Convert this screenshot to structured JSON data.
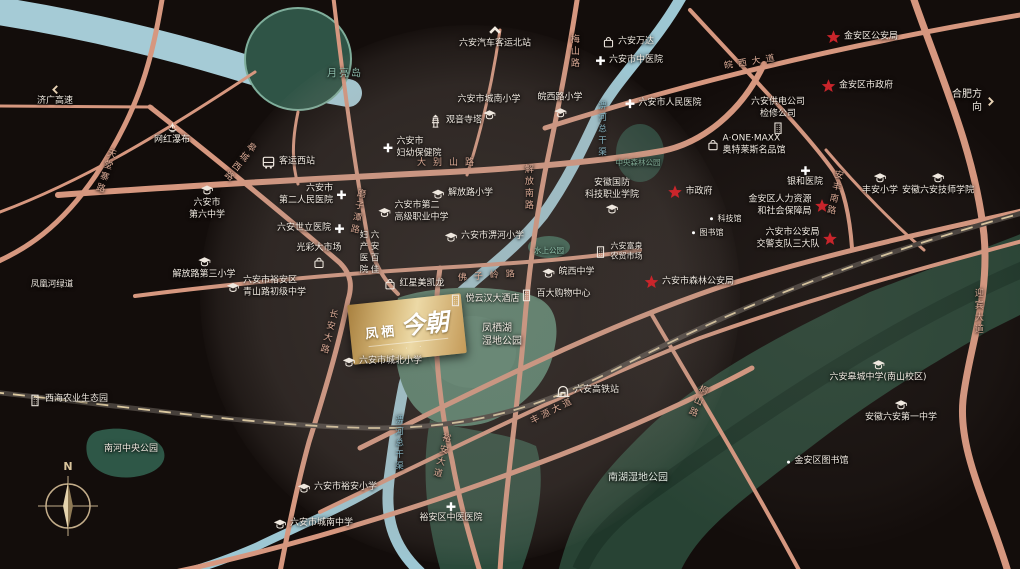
{
  "logo": {
    "brand": "凤栖",
    "script": "今朝",
    "caption": "· · ·"
  },
  "compass": {
    "north": "N"
  },
  "colors": {
    "road": "#d6977f",
    "water": "#9dc7d3",
    "wetland": "#284334",
    "lake_park": "#527d68",
    "star_red": "#c9252b",
    "label": "#f1eae1",
    "road_label": "#dcab96",
    "logo_gold": "#d8ba7c"
  },
  "pois": [
    {
      "name": "jiguang-expressway-sign",
      "label": "济广高速",
      "icon": "chev-left",
      "x": 55,
      "y": 96,
      "lay": "col",
      "ic": "#e8d2b4"
    },
    {
      "name": "north-bus-station-sign",
      "label": "六安汽车客运北站",
      "icon": "chev-up",
      "x": 495,
      "y": 37,
      "lay": "col",
      "ic": "#f0e9df"
    },
    {
      "name": "hefei-direction-sign",
      "label": "合肥方向",
      "icon": "chev-right",
      "x": 972,
      "y": 101,
      "lay": "row-r",
      "ic": "#e8d2b4",
      "fs": 10
    },
    {
      "name": "wanghong-waterfall",
      "label": "网红瀑布",
      "icon": "fountain",
      "x": 172,
      "y": 134,
      "lay": "col"
    },
    {
      "name": "west-bus-station",
      "label": "客运西站",
      "icon": "bus",
      "x": 288,
      "y": 162,
      "lay": "row"
    },
    {
      "name": "moon-island",
      "label": "月亮岛",
      "x": 345,
      "y": 74,
      "lay": "text",
      "c": "#8fbfae",
      "fs": 10,
      "ls": 2
    },
    {
      "name": "meishan-road",
      "label": "梅山路",
      "x": 573,
      "y": 52,
      "lay": "text",
      "vert": true,
      "c": "#dcab96"
    },
    {
      "name": "wanda-mall",
      "label": "六安万达",
      "icon": "bag",
      "x": 628,
      "y": 42,
      "lay": "row"
    },
    {
      "name": "tcm-hospital",
      "label": "六安市中医院",
      "icon": "cross",
      "x": 629,
      "y": 61,
      "lay": "row"
    },
    {
      "name": "chengnan-primary",
      "label": "六安市城南小学",
      "icon": "cap",
      "x": 489,
      "y": 108,
      "lay": "col-r"
    },
    {
      "name": "wanxilu-primary",
      "label": "皖西路小学",
      "icon": "cap",
      "x": 560,
      "y": 106,
      "lay": "col-r"
    },
    {
      "name": "renmin-hospital",
      "label": "六安市人民医院",
      "icon": "cross",
      "x": 663,
      "y": 104,
      "lay": "row"
    },
    {
      "name": "guanyin-pagoda",
      "label": "观音寺塔",
      "icon": "pagoda",
      "x": 455,
      "y": 121,
      "lay": "row"
    },
    {
      "name": "maternity-care-hospital",
      "label": "六安市\n妇幼保健院",
      "icon": "cross",
      "x": 412,
      "y": 148,
      "lay": "row"
    },
    {
      "name": "dabieshan-road",
      "label": "大别山路",
      "x": 449,
      "y": 164,
      "lay": "text",
      "c": "#dcab96",
      "ls": 7
    },
    {
      "name": "tiantangzhai-road",
      "label": "天堂寨路",
      "x": 104,
      "y": 171,
      "lay": "text",
      "vert": true,
      "c": "#dcab96",
      "rot": 18
    },
    {
      "name": "gaochengxi-road",
      "label": "皋城西路",
      "x": 238,
      "y": 161,
      "lay": "text",
      "vert": true,
      "c": "#dcab96",
      "rot": 38
    },
    {
      "name": "no6-middle-school",
      "label": "六安市\n第六中学",
      "icon": "cap",
      "x": 207,
      "y": 202,
      "lay": "col"
    },
    {
      "name": "no2-renmin-hospital",
      "label": "六安市\n第二人民医院",
      "icon": "cross",
      "x": 313,
      "y": 195,
      "lay": "row-r"
    },
    {
      "name": "shili-hospital",
      "label": "六安世立医院",
      "icon": "cross",
      "x": 311,
      "y": 229,
      "lay": "row-r"
    },
    {
      "name": "guangcai-market",
      "label": "光彩大市场",
      "icon": "bag",
      "x": 319,
      "y": 256,
      "lay": "col-r"
    },
    {
      "name": "qingshanlu-junior-middle-school",
      "label": "六安市裕安区\n青山路初级中学",
      "icon": "cap",
      "x": 266,
      "y": 287,
      "lay": "row"
    },
    {
      "name": "jiefanglu-no3-primary",
      "label": "解放路第三小学",
      "icon": "cap",
      "x": 204,
      "y": 268,
      "lay": "col"
    },
    {
      "name": "fenghuang-river-greenway",
      "label": "凤凰河绿道",
      "x": 52,
      "y": 285,
      "lay": "text",
      "fs": 8.5
    },
    {
      "name": "mozitan-road",
      "label": "磨子潭路",
      "x": 356,
      "y": 212,
      "lay": "text",
      "vert": true,
      "c": "#dcab96",
      "rot": 10
    },
    {
      "name": "no2-vocational-school",
      "label": "六安市第二\n高级职业中学",
      "icon": "cap",
      "x": 413,
      "y": 212,
      "lay": "row"
    },
    {
      "name": "jiefanglu-primary",
      "label": "解放路小学",
      "icon": "cap",
      "x": 462,
      "y": 194,
      "lay": "row"
    },
    {
      "name": "pihe-primary",
      "label": "六安市淠河小学",
      "icon": "cap",
      "x": 484,
      "y": 237,
      "lay": "row"
    },
    {
      "name": "jiefangnan-road",
      "label": "解放南路",
      "x": 527,
      "y": 188,
      "lay": "text",
      "vert": true,
      "c": "#dcab96"
    },
    {
      "name": "baijia-maternity-hospital",
      "label": "六安百佳\n妇产医院",
      "x": 368,
      "y": 253,
      "lay": "text",
      "vert": true,
      "fs": 8.5
    },
    {
      "name": "hongxing-meikailong",
      "label": "红星美凯龙",
      "icon": "bag",
      "x": 414,
      "y": 284,
      "lay": "row"
    },
    {
      "name": "foziling-road",
      "label": "佛子岭路",
      "x": 490,
      "y": 277,
      "lay": "text",
      "c": "#dcab96",
      "ls": 7,
      "rot": -4
    },
    {
      "name": "guofang-tech-college",
      "label": "安徽国防\n科技职业学院",
      "icon": "cap",
      "x": 612,
      "y": 197,
      "lay": "col-r"
    },
    {
      "name": "central-forest-park",
      "label": "中央森林公园",
      "x": 638,
      "y": 163,
      "lay": "text",
      "c": "#7fa893",
      "fs": 7.5
    },
    {
      "name": "pihe-main-channel-north",
      "label": "淠河总干渠",
      "x": 601,
      "y": 130,
      "lay": "text",
      "vert": true,
      "c": "#86b4c2",
      "fs": 8.5
    },
    {
      "name": "city-hall",
      "label": "市政府",
      "icon": "star",
      "x": 690,
      "y": 192,
      "lay": "row"
    },
    {
      "name": "science-museum",
      "label": "科技馆",
      "icon": "dot",
      "x": 725,
      "y": 219,
      "lay": "row",
      "fs": 8
    },
    {
      "name": "library",
      "label": "图书馆",
      "icon": "dot",
      "x": 707,
      "y": 233,
      "lay": "row",
      "fs": 8
    },
    {
      "name": "power-supply-company",
      "label": "六安供电公司\n检修公司",
      "icon": "building",
      "x": 778,
      "y": 116,
      "lay": "col-r"
    },
    {
      "name": "aone-maxx-outlets",
      "label": "A·ONE·MAXX\n奥特莱斯名品馆",
      "icon": "bag",
      "x": 746,
      "y": 145,
      "lay": "row"
    },
    {
      "name": "jinan-district-police",
      "label": "金安区公安局",
      "icon": "star",
      "x": 862,
      "y": 37,
      "lay": "row"
    },
    {
      "name": "wanxi-avenue",
      "label": "皖西大道",
      "x": 752,
      "y": 63,
      "lay": "text",
      "c": "#dcab96",
      "ls": 5,
      "rot": -9
    },
    {
      "name": "jinan-district-govt",
      "label": "金安区市政府",
      "icon": "star",
      "x": 857,
      "y": 86,
      "lay": "row"
    },
    {
      "name": "yinhe-hospital",
      "label": "银和医院",
      "icon": "cross",
      "x": 805,
      "y": 177,
      "lay": "col"
    },
    {
      "name": "fengan-primary",
      "label": "丰安小学",
      "icon": "cap",
      "x": 880,
      "y": 184,
      "lay": "col"
    },
    {
      "name": "luan-technician-college",
      "label": "安徽六安技师学院",
      "icon": "cap",
      "x": 938,
      "y": 184,
      "lay": "col"
    },
    {
      "name": "hr-social-security-bureau",
      "label": "金安区人力资源\n和社会保障局",
      "icon": "star",
      "x": 789,
      "y": 206,
      "lay": "row-r"
    },
    {
      "name": "traffic-police-no3",
      "label": "六安市公安局\n交警支队三大队",
      "icon": "star",
      "x": 797,
      "y": 239,
      "lay": "row-r"
    },
    {
      "name": "forest-police-bureau",
      "label": "六安市森林公安局",
      "icon": "star",
      "x": 689,
      "y": 282,
      "lay": "row"
    },
    {
      "name": "anfengnan-road",
      "label": "安丰南路",
      "x": 833,
      "y": 193,
      "lay": "text",
      "vert": true,
      "c": "#dcab96",
      "rot": 12
    },
    {
      "name": "water-park",
      "label": "水上公园",
      "x": 549,
      "y": 251,
      "lay": "text",
      "c": "#8fc0aa",
      "fs": 7.5
    },
    {
      "name": "fuquan-farmers-market",
      "label": "六安富泉\n农贸市场",
      "icon": "building",
      "x": 618,
      "y": 252,
      "lay": "row",
      "fs": 8
    },
    {
      "name": "wanxi-middle-school",
      "label": "皖西中学",
      "icon": "cap",
      "x": 568,
      "y": 273,
      "lay": "row"
    },
    {
      "name": "baida-shopping-center",
      "label": "百大购物中心",
      "icon": "building",
      "x": 555,
      "y": 295,
      "lay": "row"
    },
    {
      "name": "yunhan-hotel",
      "label": "悦云汉大酒店",
      "icon": "building",
      "x": 484,
      "y": 300,
      "lay": "row"
    },
    {
      "name": "fengqi-lake-wetland-park",
      "label": "凤栖湖\n湿地公园",
      "x": 502,
      "y": 335,
      "lay": "text",
      "fs": 10
    },
    {
      "name": "chengbei-primary",
      "label": "六安市城北小学",
      "icon": "cap",
      "x": 382,
      "y": 362,
      "lay": "row"
    },
    {
      "name": "changan-road",
      "label": "长安大路",
      "x": 327,
      "y": 332,
      "lay": "text",
      "vert": true,
      "c": "#dcab96",
      "rot": 14
    },
    {
      "name": "pihe-main-channel-south",
      "label": "淠河总干渠",
      "x": 398,
      "y": 444,
      "lay": "text",
      "vert": true,
      "c": "#86b4c2",
      "fs": 8.5
    },
    {
      "name": "yuan-avenue",
      "label": "裕安大道",
      "x": 440,
      "y": 456,
      "lay": "text",
      "vert": true,
      "c": "#dcab96",
      "rot": 14
    },
    {
      "name": "fengyuan-avenue",
      "label": "丰源大道",
      "x": 553,
      "y": 412,
      "lay": "text",
      "c": "#dcab96",
      "rot": -27,
      "ls": 3
    },
    {
      "name": "luan-hsr-station",
      "label": "六安高铁站",
      "icon": "train",
      "x": 587,
      "y": 391,
      "lay": "row"
    },
    {
      "name": "nanhu-wetland-park",
      "label": "南湖湿地公园",
      "x": 638,
      "y": 478,
      "lay": "text",
      "fs": 10,
      "c": "#dfe8df"
    },
    {
      "name": "tongshan-road",
      "label": "桐山路",
      "x": 696,
      "y": 401,
      "lay": "text",
      "vert": true,
      "c": "#dcab96",
      "rot": 24
    },
    {
      "name": "yingbin-avenue",
      "label": "迎宾大道",
      "x": 977,
      "y": 312,
      "lay": "text",
      "vert": true,
      "c": "#dcab96"
    },
    {
      "name": "gaocheng-middle-school",
      "label": "六安皋城中学(南山校区)",
      "icon": "cap",
      "x": 878,
      "y": 371,
      "lay": "col"
    },
    {
      "name": "anhui-luan-no1-middle-school",
      "label": "安徽六安第一中学",
      "icon": "cap",
      "x": 901,
      "y": 411,
      "lay": "col"
    },
    {
      "name": "jinan-district-library",
      "label": "金安区图书馆",
      "icon": "dot",
      "x": 817,
      "y": 462,
      "lay": "row"
    },
    {
      "name": "xihai-agriculture-eco-park",
      "label": "西海农业生态园",
      "icon": "building",
      "x": 68,
      "y": 400,
      "lay": "row"
    },
    {
      "name": "nanhe-central-park",
      "label": "南河中央公园",
      "x": 131,
      "y": 450,
      "lay": "text"
    },
    {
      "name": "yuan-primary",
      "label": "六安市裕安小学",
      "icon": "cap",
      "x": 337,
      "y": 488,
      "lay": "row"
    },
    {
      "name": "chengnan-middle-school",
      "label": "六安市城南中学",
      "icon": "cap",
      "x": 313,
      "y": 524,
      "lay": "row"
    },
    {
      "name": "yuanqu-tcm-hospital",
      "label": "裕安区中医医院",
      "icon": "cross",
      "x": 451,
      "y": 513,
      "lay": "col"
    }
  ]
}
